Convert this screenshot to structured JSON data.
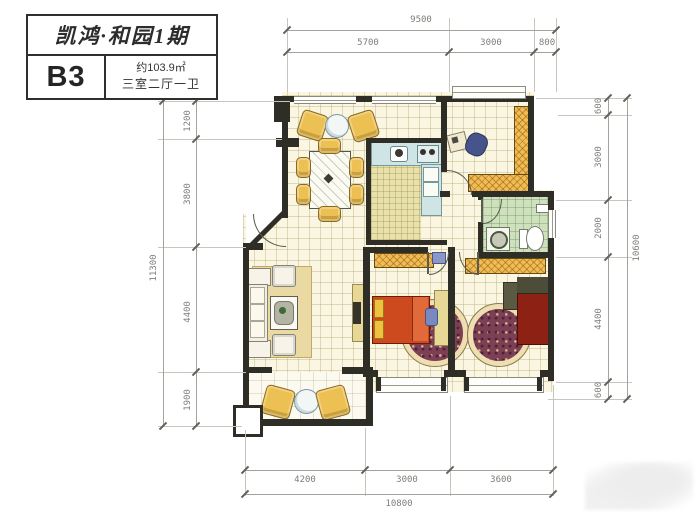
{
  "title_block": {
    "project": "凯鸿·和园1期",
    "unit": "B3",
    "area": "约103.9㎡",
    "rooms": "三室二厅一卫"
  },
  "dimensions": {
    "top": {
      "total": "9500",
      "segments": [
        "5700",
        "3000",
        "800"
      ]
    },
    "left": {
      "total": "11300",
      "segments": [
        "1200",
        "3800",
        "4400",
        "1900"
      ]
    },
    "right": {
      "total": "10600",
      "segments": [
        "600",
        "3000",
        "2000",
        "4400",
        "600"
      ]
    },
    "bottom": {
      "total": "10800",
      "segments": [
        "4200",
        "3000",
        "3600"
      ]
    }
  },
  "colors": {
    "wall": "#2e2d26",
    "floor": "#faf6e2",
    "kitchen_counter": "#cfe4e4",
    "bathroom_floor": "#cfe0bf",
    "wardrobe": "#f0bd55",
    "bed_middle": "#cc4a1e",
    "bed_master": "#8c2114",
    "chair_yellow": "#ecc052",
    "rug": "#7c4054",
    "dimension_text": "#7d7d78"
  }
}
